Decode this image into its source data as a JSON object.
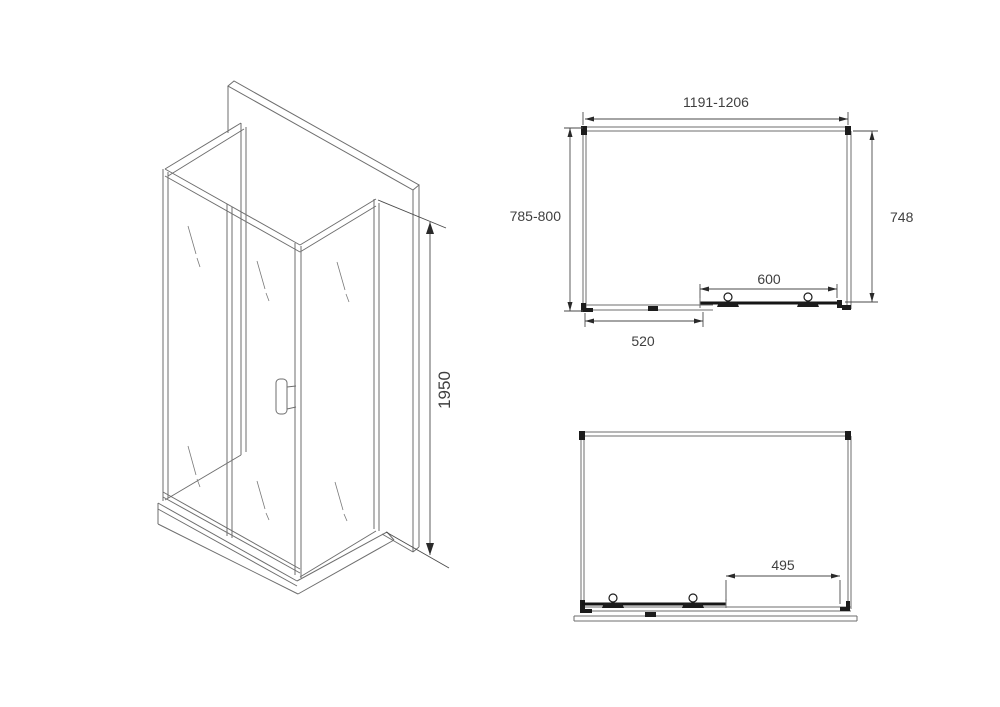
{
  "page": {
    "background_color": "#ffffff",
    "line_color": "#6e6e6e",
    "bold_line_color": "#161616",
    "text_color": "#3f3f3f"
  },
  "isometric_view": {
    "height_dim": "1950"
  },
  "plan_view_closed": {
    "overall_width_dim": "1191-1206",
    "overall_depth_dim": "785-800",
    "inner_depth_dim": "748",
    "door_width_dim": "600",
    "fixed_panel_width_dim": "520"
  },
  "plan_view_open": {
    "opening_width_dim": "495"
  }
}
